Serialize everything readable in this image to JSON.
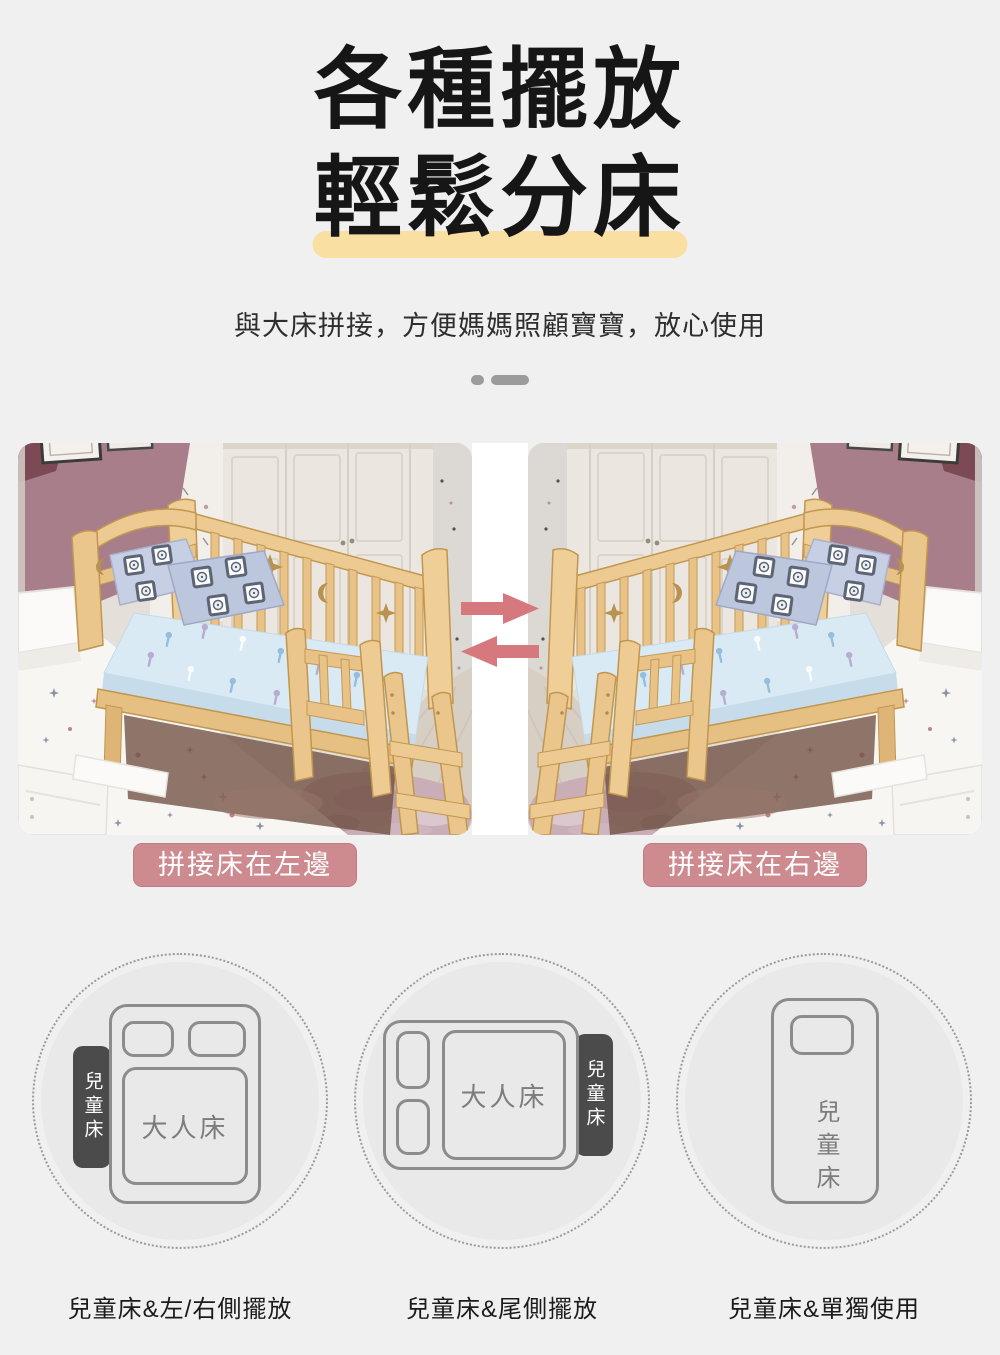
{
  "header": {
    "title_line1": "各種擺放",
    "title_line2": "輕鬆分床",
    "subtitle": "與大床拼接，方便媽媽照顧寶寶，放心使用"
  },
  "photos": {
    "left_label": "拼接床在左邊",
    "right_label": "拼接床在右邊",
    "description": "木質兒童拼接床實拍圖，左右兩張互為鏡像"
  },
  "icons": {
    "swap_right": "arrow-right-icon",
    "swap_left": "arrow-left-icon",
    "divider": "dot-dash-divider"
  },
  "colors": {
    "page_bg": "#f0f0f0",
    "title_text": "#161616",
    "highlight_yellow": "#fadfa3",
    "badge_rose": "#cd8b90",
    "arrow_rose": "#d5797f",
    "divider_gray": "#9b9b9b",
    "circle_fill": "#e9e9e9",
    "diagram_stroke": "#8c8c8c",
    "child_tag_dark": "#4b4b4b"
  },
  "layouts": {
    "items": [
      {
        "caption": "兒童床&左/右側擺放",
        "adult_bed": "大人床",
        "child_bed": "兒童床",
        "child_position": "left-side"
      },
      {
        "caption": "兒童床&尾側擺放",
        "adult_bed": "大人床",
        "child_bed": "兒童床",
        "child_position": "foot-side"
      },
      {
        "caption": "兒童床&單獨使用",
        "child_bed": "兒童床",
        "child_position": "standalone"
      }
    ]
  }
}
